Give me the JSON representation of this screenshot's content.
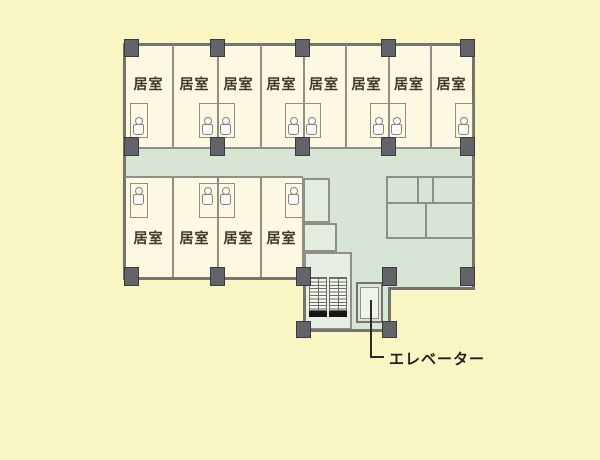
{
  "plan": {
    "type": "hotel-floor-plan",
    "top_rooms": [
      {
        "label": "居室"
      },
      {
        "label": "居室"
      },
      {
        "label": "居室"
      },
      {
        "label": "居室"
      },
      {
        "label": "居室"
      },
      {
        "label": "居室"
      },
      {
        "label": "居室"
      },
      {
        "label": "居室"
      }
    ],
    "bottom_rooms": [
      {
        "label": "居室"
      },
      {
        "label": "居室"
      },
      {
        "label": "居室"
      },
      {
        "label": "居室"
      }
    ],
    "elevator": {
      "label": "エレベーター"
    },
    "icons": {
      "toilet": "toilet-icon",
      "stairs": "stair-flight-hatch",
      "column": "structural-column"
    },
    "colors": {
      "background": "#faf6c3",
      "room_fill": "#fdf8e2",
      "corridor_fill": "#d7e5d5",
      "utility_fill": "#e3ece1",
      "stair_fill": "#f3f6ef",
      "exterior_wall": "#74746d",
      "interior_wall": "#8f8f88",
      "column_fill": "#63636a",
      "room_label_text": "#44362a",
      "elevator_label_text": "#1f1f1f"
    }
  }
}
